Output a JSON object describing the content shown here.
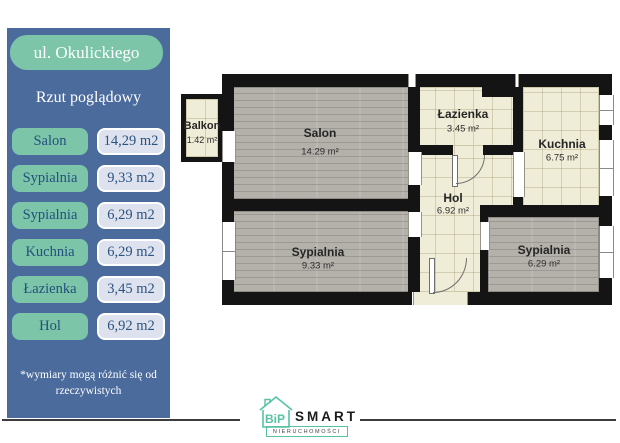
{
  "sidebar": {
    "address": "ul. Okulickiego",
    "subtitle": "Rzut poglądowy",
    "rooms": [
      {
        "name": "Salon",
        "area": "14,29 m2"
      },
      {
        "name": "Sypialnia",
        "area": "9,33 m2"
      },
      {
        "name": "Sypialnia",
        "area": "6,29 m2"
      },
      {
        "name": "Kuchnia",
        "area": "6,29 m2"
      },
      {
        "name": "Łazienka",
        "area": "3,45 m2"
      },
      {
        "name": "Hol",
        "area": "6,92 m2"
      }
    ],
    "disclaimer": "*wymiary mogą różnić się od rzeczywistych"
  },
  "plan": {
    "balkon": {
      "name": "Balkon",
      "area": "1.42 m²"
    },
    "salon": {
      "name": "Salon",
      "area": "14.29 m²"
    },
    "lazienka": {
      "name": "Łazienka",
      "area": "3.45 m²"
    },
    "kuchnia": {
      "name": "Kuchnia",
      "area": "6.75 m²"
    },
    "hol": {
      "name": "Hol",
      "area": "6.92 m²"
    },
    "sypialnia1": {
      "name": "Sypialnia",
      "area": "9.33 m²"
    },
    "sypialnia2": {
      "name": "Sypialnia",
      "area": "6.29 m²"
    }
  },
  "logo": {
    "house_letters": "BiP",
    "brand": "SMART",
    "sub": "NIERUCHOMOŚCI"
  },
  "colors": {
    "sidebar_bg": "#4a6b9c",
    "accent_teal": "#7cc5a9",
    "pill_light": "#dde2ee",
    "pill_text": "#2c5380",
    "wall_black": "#141414",
    "floor_cream": "#efecd7",
    "floor_gray": "#b4b1ab",
    "logo_teal": "#56c2a4"
  }
}
